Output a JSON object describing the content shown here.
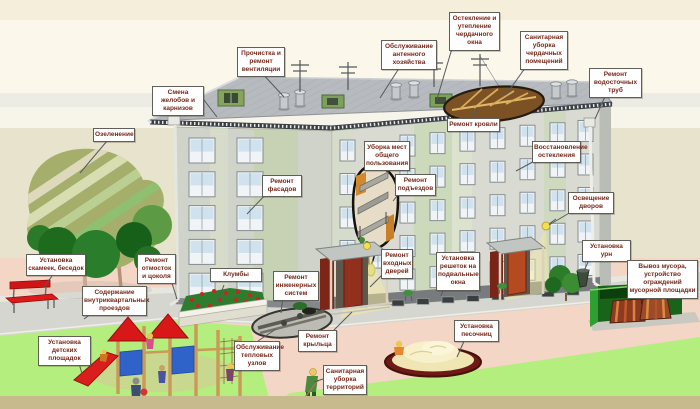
{
  "scene": {
    "description": "Схема обслуживания жилого дома и придомовой территории",
    "language": "ru"
  },
  "palette": {
    "label_text": "#772718",
    "label_bg": "#ffffff",
    "label_border": "#5f5f57",
    "sky_cream": "#fbf7ea",
    "wall_olive": "#e7e3cd",
    "ground_pink": "#f3d6c6",
    "lawn_green": "#b4ee7e",
    "road_gray": "#d6d6d0",
    "bottom_strip": "#c7bb8e",
    "facade_gray": "#d9dbd3",
    "facade_green_panel": "#c9d8b6",
    "roof_gray": "#b7babe",
    "bench_red": "#d81818",
    "playground_red": "#d81818",
    "playground_blue": "#2f63c9",
    "sand_yellow": "#efe6b4",
    "sandbox_rim": "#6f1a14",
    "trash_green": "#2f9e33",
    "door_red": "#93301d",
    "attic_wood": "#7c5224",
    "lamp_yellow": "#f2df52"
  },
  "labels": [
    {
      "id": "smena-zhelobov",
      "text": "Смена желобов и карнизов"
    },
    {
      "id": "prochistka-ventilyacii",
      "text": "Прочистка и ремонт вентиляции"
    },
    {
      "id": "antennoe-hozyaystvo",
      "text": "Обслуживание антенного хозяйства"
    },
    {
      "id": "osteklenie-cherdachnogo-okna",
      "text": "Остекление и утепление чердачного окна"
    },
    {
      "id": "uborka-cherdachnyh",
      "text": "Санитарная уборка чердачных помещений"
    },
    {
      "id": "vodostochnye-truby",
      "text": "Ремонт водосточных труб"
    },
    {
      "id": "ozelenenie",
      "text": "Озеленение"
    },
    {
      "id": "remont-krovli",
      "text": "Ремонт кровли"
    },
    {
      "id": "uborka-mest",
      "text": "Уборка мест общего пользования"
    },
    {
      "id": "vosstanovlenie-ostekleniya",
      "text": "Восстановление остекления"
    },
    {
      "id": "remont-fasadov",
      "text": "Ремонт фасадов"
    },
    {
      "id": "remont-podezdov",
      "text": "Ремонт подъездов"
    },
    {
      "id": "osveshchenie-dvorov",
      "text": "Освещение дворов"
    },
    {
      "id": "ustanovka-urn",
      "text": "Установка урн"
    },
    {
      "id": "ustanovka-skameek",
      "text": "Установка скамеек, беседок"
    },
    {
      "id": "remont-otmostok",
      "text": "Ремонт отмосток и цоколя"
    },
    {
      "id": "soderzhanie-proezdov",
      "text": "Содержание внутриквартальных проездов"
    },
    {
      "id": "klumby",
      "text": "Клумбы"
    },
    {
      "id": "remont-inzhenernyh-sistem",
      "text": "Ремонт инженерных систем"
    },
    {
      "id": "remont-vhodnyh-dverey",
      "text": "Ремонт входных дверей"
    },
    {
      "id": "reshetki-na-podvalnye-okna",
      "text": "Установка решеток на подвальные окна"
    },
    {
      "id": "vyvoz-musora",
      "text": "Вывоз мусора, устройство ограждений мусорной площадки"
    },
    {
      "id": "detskie-ploshchadki",
      "text": "Установка детских площадок"
    },
    {
      "id": "teplovye-uzly",
      "text": "Обслуживание тепловых узлов"
    },
    {
      "id": "remont-kryltsa",
      "text": "Ремонт крыльца"
    },
    {
      "id": "uborka-territoriy",
      "text": "Санитарная уборка территорий"
    },
    {
      "id": "ustanovka-pesochnits",
      "text": "Установка песочниц"
    }
  ]
}
